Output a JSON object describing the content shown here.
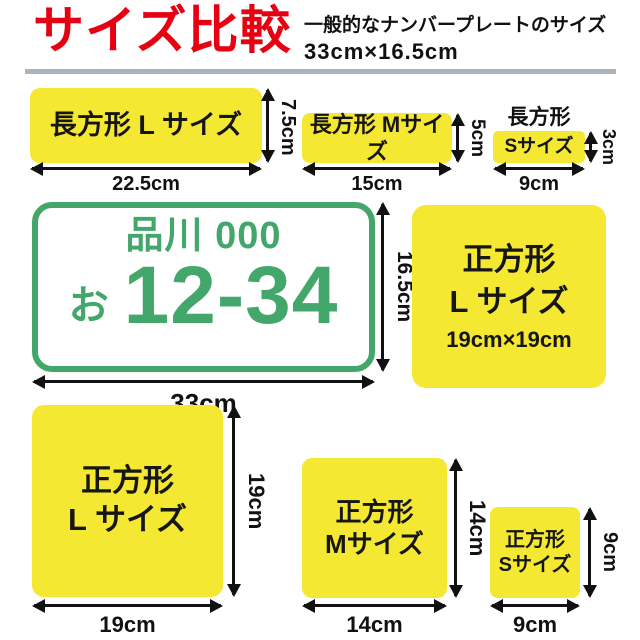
{
  "header": {
    "title": "サイズ比較",
    "subtitle_line1": "一般的なナンバープレートのサイズ",
    "subtitle_line2": "33cm×16.5cm"
  },
  "colors": {
    "accent_red": "#e60012",
    "sticker_yellow": "#f5e832",
    "plate_green": "#43a76c",
    "divider_gray": "#a9b5ba",
    "text_black": "#111111"
  },
  "plate": {
    "region": "品川 000",
    "hiragana": "お",
    "number": "12-34",
    "width_label": "33cm",
    "height_label": "16.5cm"
  },
  "rects": [
    {
      "label": "長方形 L サイズ",
      "width_label": "22.5cm",
      "height_label": "7.5cm"
    },
    {
      "label": "長方形 Mサイズ",
      "width_label": "15cm",
      "height_label": "5cm"
    },
    {
      "label_above": "長方形",
      "label": "Sサイズ",
      "width_label": "9cm",
      "height_label": "3cm"
    }
  ],
  "square_info": {
    "line1": "正方形",
    "line2": "L サイズ",
    "line3": "19cm×19cm"
  },
  "squares": [
    {
      "line1": "正方形",
      "line2": "L サイズ",
      "width_label": "19cm",
      "height_label": "19cm"
    },
    {
      "line1": "正方形",
      "line2": "Mサイズ",
      "width_label": "14cm",
      "height_label": "14cm"
    },
    {
      "line1": "正方形",
      "line2": "Sサイズ",
      "width_label": "9cm",
      "height_label": "9cm"
    }
  ]
}
